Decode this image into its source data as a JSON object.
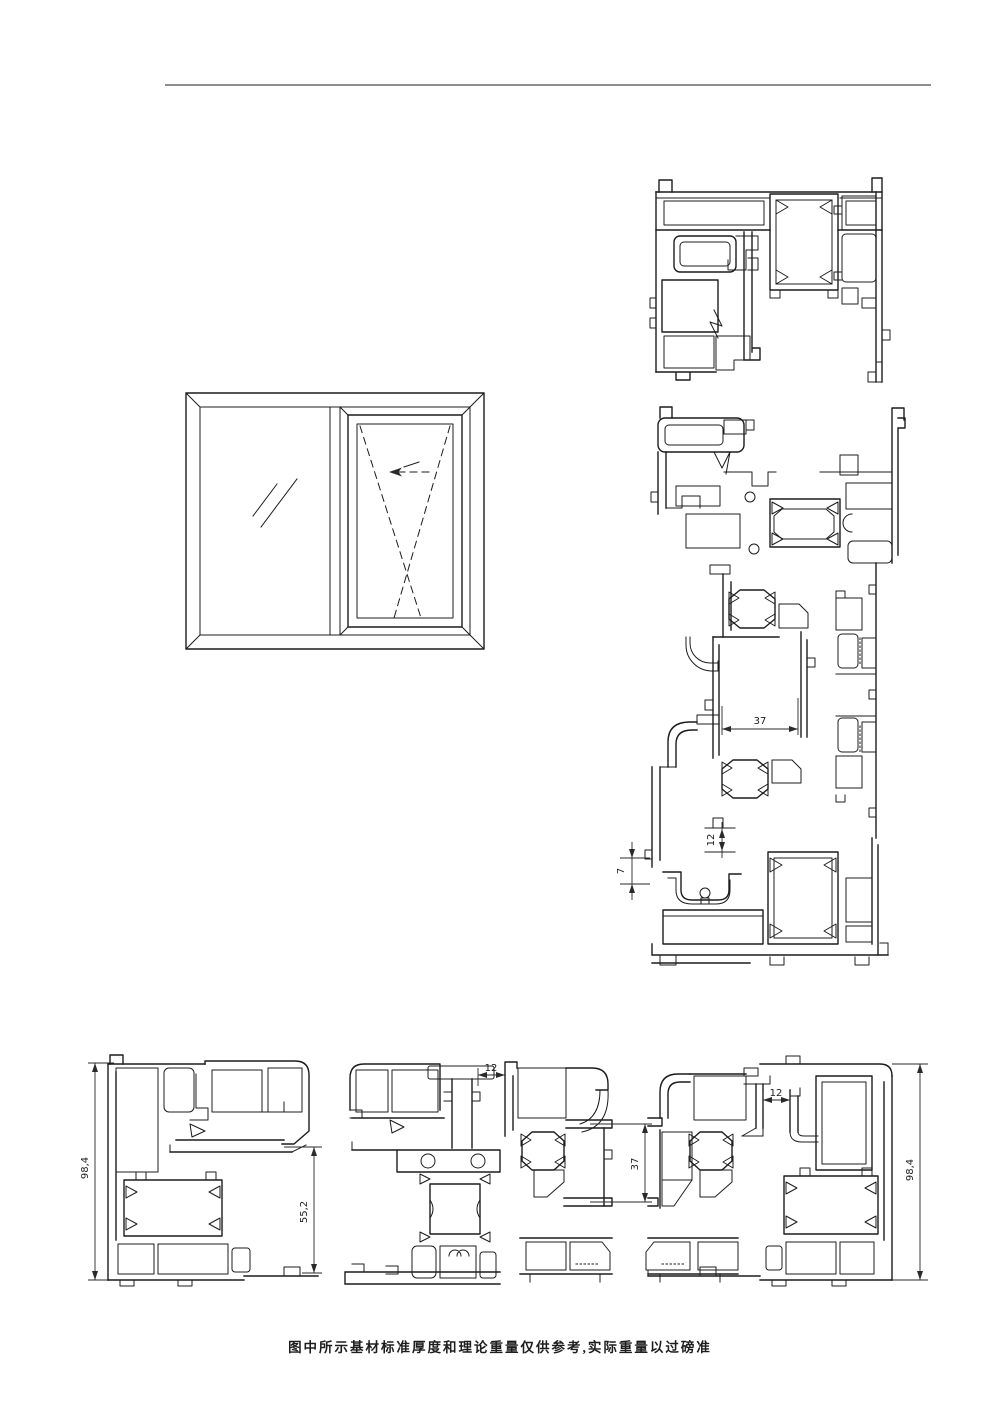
{
  "colors": {
    "line": "#1c1c1c",
    "dimension": "#2a2a2a",
    "rule": "#8d8d8d",
    "background": "#ffffff"
  },
  "footer": {
    "note": "图中所示基材标准厚度和理论重量仅供参考,实际重量以过磅准"
  },
  "dims": {
    "right_section": {
      "d37": "37",
      "d12": "12",
      "d7": "7"
    },
    "bottom_left": {
      "overall_height": "98,4",
      "sash_height": "55,2"
    },
    "bottom_middle": {
      "gap12": "12",
      "d37": "37"
    },
    "bottom_right": {
      "gap12": "12",
      "overall_height": "98,4"
    }
  }
}
